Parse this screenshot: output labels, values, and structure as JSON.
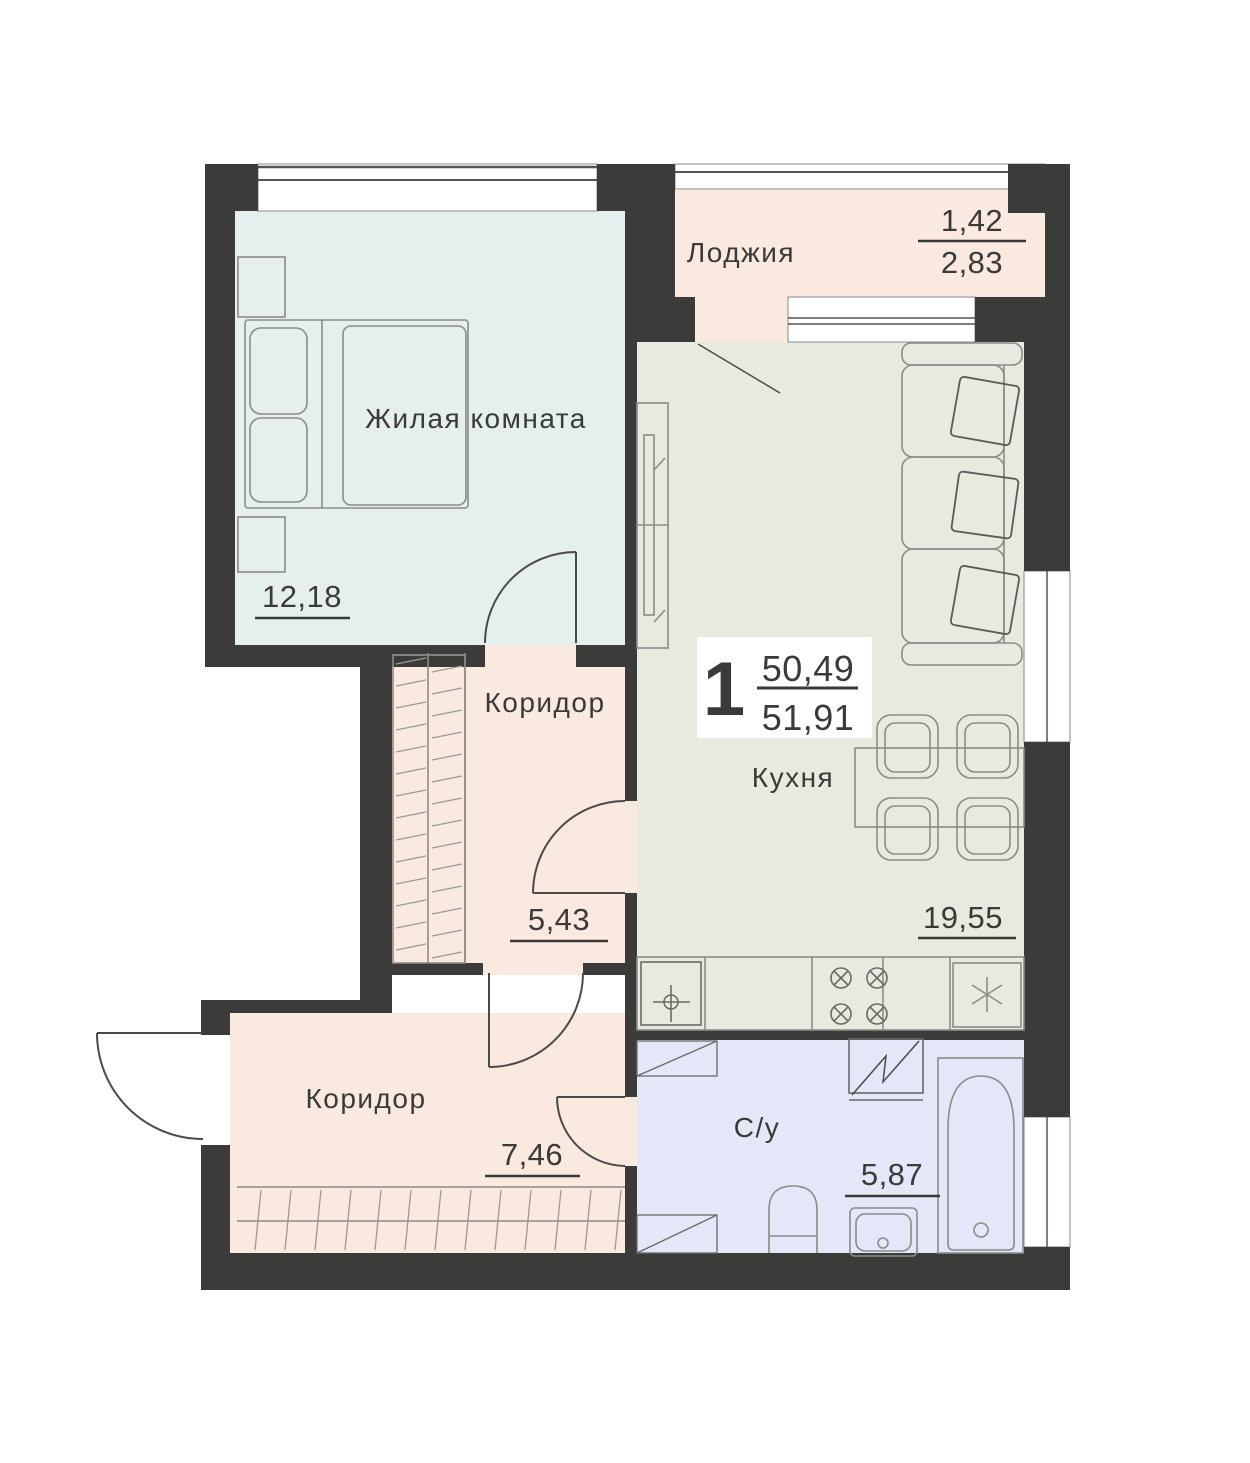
{
  "plan": {
    "badge": {
      "rooms_count": "1",
      "living_area": "50,49",
      "total_area": "51,91"
    },
    "rooms": {
      "living": {
        "label": "Жилая комната",
        "area": "12,18"
      },
      "loggia": {
        "label": "Лоджия",
        "area_coef": "1,42",
        "area_full": "2,83"
      },
      "kitchen": {
        "label": "Кухня",
        "area": "19,55"
      },
      "corridor_top": {
        "label": "Коридор",
        "area": "5,43"
      },
      "corridor_bottom": {
        "label": "Коридор",
        "area": "7,46"
      },
      "bathroom": {
        "label": "С/у",
        "area": "5,87"
      }
    },
    "colors": {
      "wall": "#3b3b39",
      "living_fill": "#e4efee",
      "corridor_fill": "#f9e9de",
      "kitchen_fill": "#e7eade",
      "bathroom_fill": "#e3e7f7",
      "window_fill": "#ffffff",
      "furniture_stroke": "#8b8b89",
      "door_stroke": "#4a4a48",
      "text": "#3a3a38"
    }
  }
}
